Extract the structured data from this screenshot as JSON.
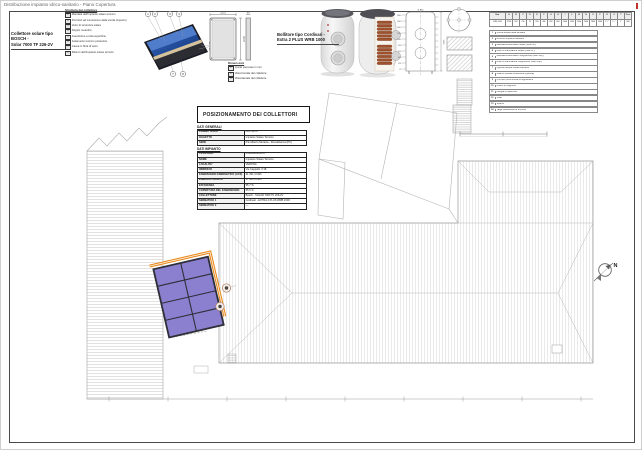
{
  "page": {
    "title": "Distribuzione impianto idrico-sanitario - Piano Copertura"
  },
  "north_label": "N",
  "collector_detail": {
    "label_line1": "Collettore solare tipo BOSCH -",
    "label_line2": "Solar 7000 TF 226-2V",
    "structure_legend": {
      "title": "Struttura del collettore",
      "items": [
        "Mandata dell'impianto solare termico",
        "Pozzetto ad immersione della sonda (coperto)",
        "Vetro di sicurezza solare",
        "Doppio meandro",
        "Assorbitore a tutta superficie",
        "Isolamento termico posteriore",
        "Cassa in fibra di vetro",
        "Ritorno dell'impianto solare termico"
      ]
    },
    "dims": {
      "width": "1175",
      "height": "2070",
      "depth": "90"
    },
    "dims_legend": {
      "title": "Dimensioni",
      "items": [
        "Quote espresse in mm",
        "Vista frontale del collettore",
        "Vista laterale del collettore"
      ]
    }
  },
  "boiler_detail": {
    "label_line1": "Bollitore tipo Cordivari -",
    "label_line2": "Extra 2 PLUS WRB 1000",
    "height_label": "2290",
    "diameter_label": "Ø 990",
    "quota_labels": [
      "1860",
      "1660",
      "1460",
      "1260",
      "1060",
      "860",
      "660",
      "460",
      "260",
      "25"
    ]
  },
  "positioning": {
    "title": "POSIZIONAMENTO DEI COLLETTORI"
  },
  "dati_generali": {
    "title": "DATI GENERALI",
    "rows": [
      [
        "COMMITTENTE",
        "Cori S.p.A."
      ],
      [
        "OGGETTO",
        "Impianto Solare Termico"
      ],
      [
        "SEDE",
        "P.le Alberto Moravia - Roccabianca (PC)"
      ]
    ]
  },
  "dati_impianto": {
    "title": "DATI IMPIANTO",
    "rows": [
      [
        "TIPOLOGIA",
        "Produzione ACS"
      ],
      [
        "NOME",
        "Impianto Solare Termico"
      ],
      [
        "LOCALITA'",
        "VERONA"
      ],
      [
        "INDIRIZZO",
        "Via Cappello n°18"
      ],
      [
        "FABBISOGNO ENERGETICO (ACS)",
        "31 031.3 kWh"
      ],
      [
        "ENERGIA FORNITA",
        "17 303.5 kWh"
      ],
      [
        "EFFICIENZA",
        "55.7 %"
      ],
      [
        "COPERTURA DEL FABBISOGNO",
        "55.5 %"
      ],
      [
        "COLLETTORE",
        "Bosch - SOLAR 7000 TF 226-2V"
      ],
      [
        "SERBATOIO 1",
        "Cordivari - EXTRA 2 PLUS WRB 1000"
      ],
      [
        "SERBATOIO 2",
        "—"
      ]
    ]
  },
  "boiler_table": {
    "columns": [
      "Mod.",
      "A",
      "B",
      "C",
      "D",
      "E",
      "F",
      "G",
      "H",
      "I",
      "L",
      "M",
      "N",
      "O",
      "P",
      "R",
      "S",
      "T",
      "Peso"
    ],
    "values": [
      "WRB 1000",
      "2290",
      "990",
      "790",
      "25",
      "260",
      "460",
      "660",
      "860",
      "1060",
      "1260",
      "1460",
      "1660",
      "1860",
      "2060",
      "1¼\"",
      "1½\"",
      "2\"",
      "380"
    ]
  },
  "connections": {
    "items": [
      "Uscita acqua calda sanitaria",
      "Ricircolo impianto sanitario",
      "Mandata scambiatore solare (fisso inf.)",
      "Ritorno scambiatore solare (fisso inf.)",
      "Mandata scambiatore integrazione (fisso sup.)",
      "Ritorno scambiatore integrazione (fisso sup.)",
      "Ingresso acqua fredda sanitaria",
      "Attacco resistenza elettrica (optional)",
      "Pozzetto porta sonda di regolazione",
      "Anodo di magnesio",
      "Flangia di ispezione",
      "Sfiato",
      "Scarico",
      "Targa caratteristiche tecniche"
    ]
  },
  "colors": {
    "panel_purple": "#8a80cf",
    "pipe_orange": "#e8891c",
    "collector_blue": "#1e4794",
    "coil_copper": "#a0522d",
    "mark_red": "#c43329"
  }
}
